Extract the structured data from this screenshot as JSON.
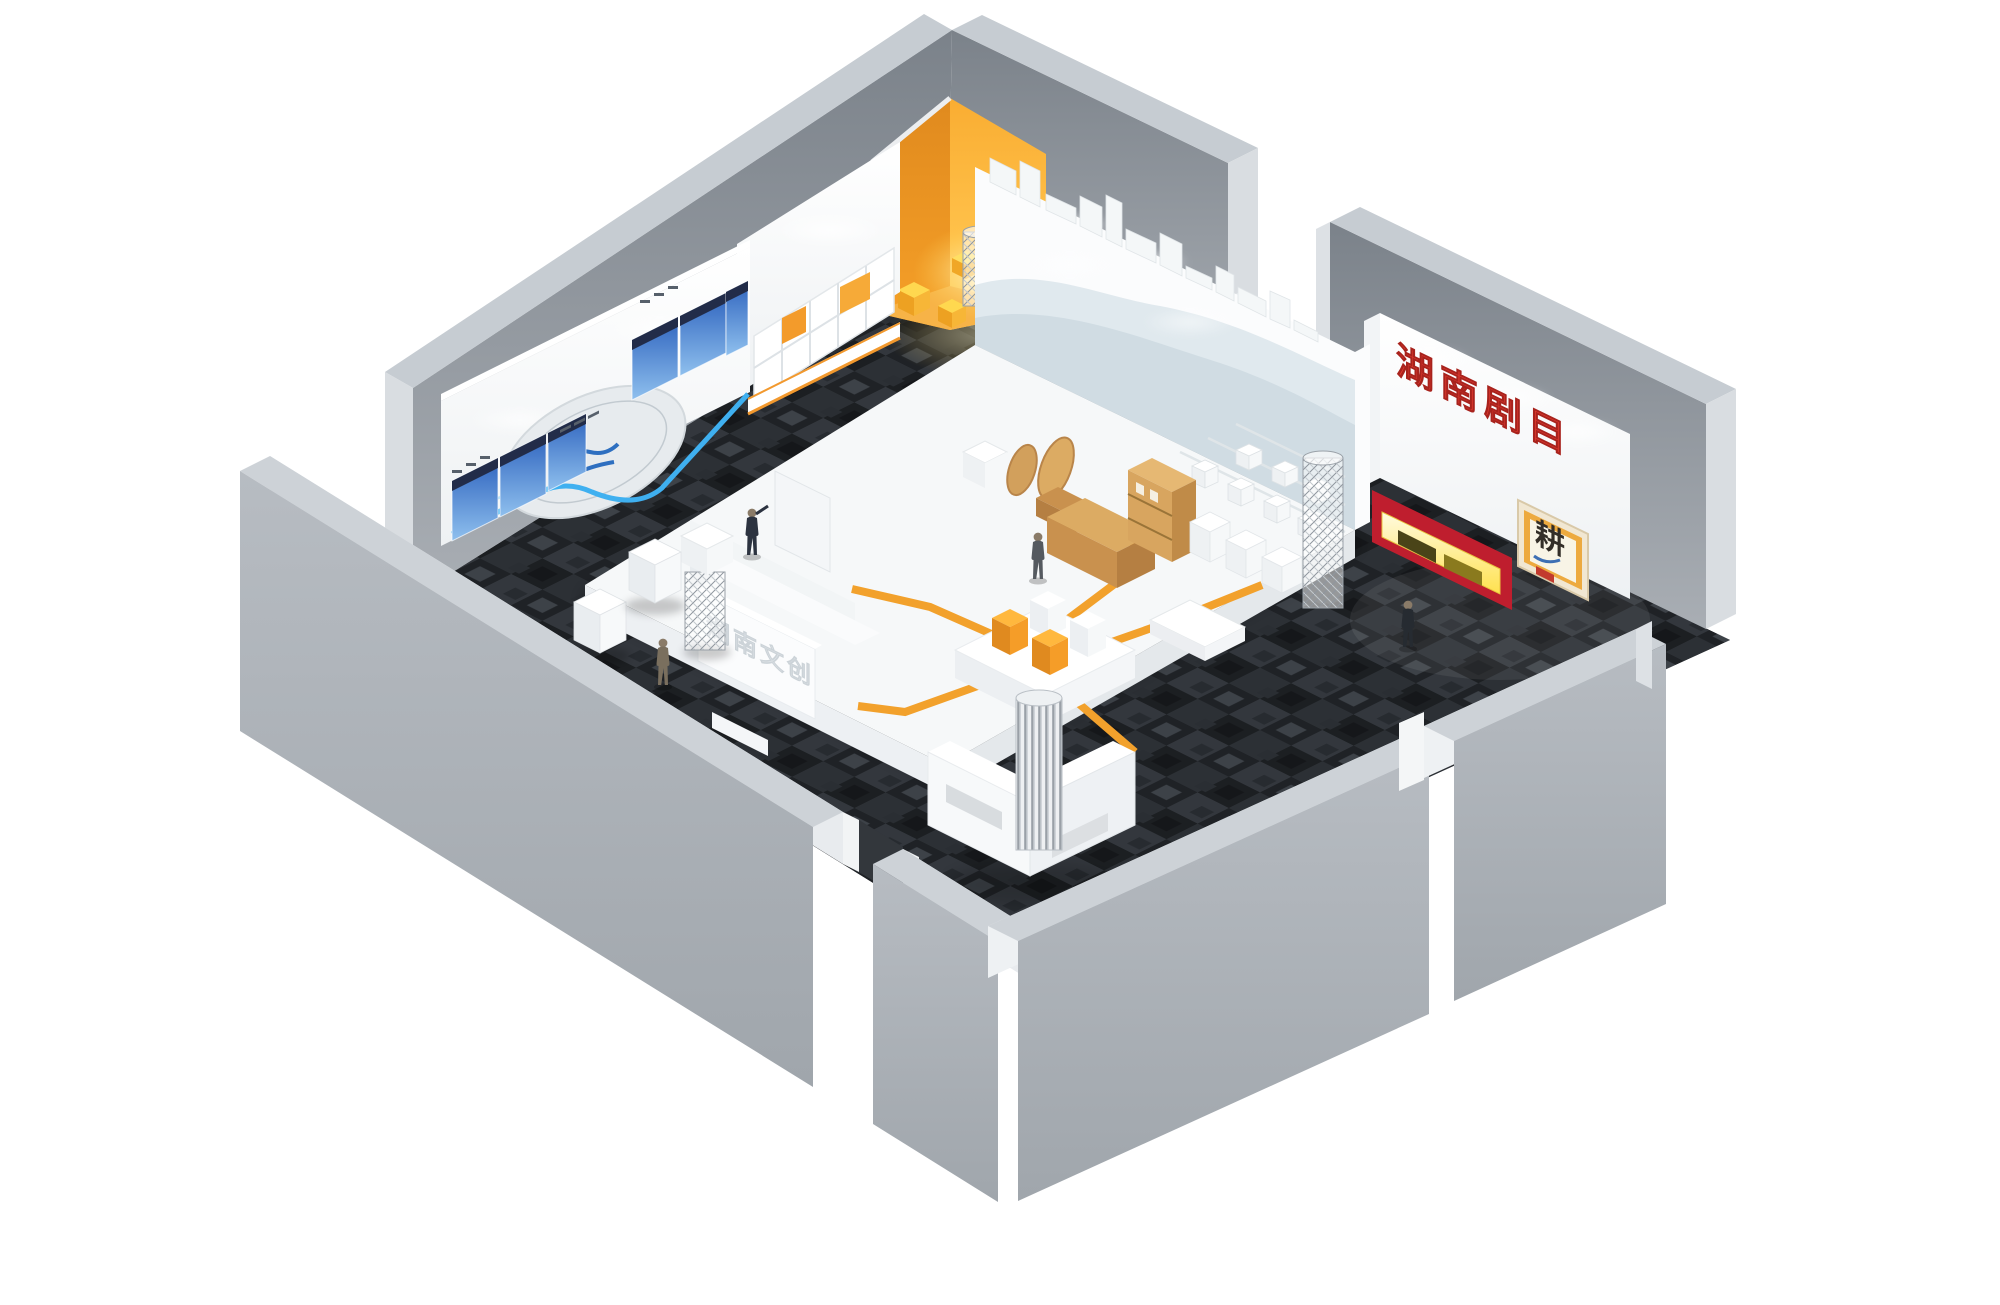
{
  "signs": {
    "creative_wall": "湖南文创",
    "drama_wall": "湖南剧目",
    "poster_character": "耕",
    "platform_relief": "湖南文创"
  },
  "palette": {
    "accent_orange": "#F2A12C",
    "gold_text": "#F6B11F",
    "red_wall": "#BF1E2E",
    "red_text": "#E23A30",
    "blue_line": "#3FB0F0",
    "carpet_base": "#24272B",
    "platform_white": "#F6F8F9",
    "wood": "#DCAB63",
    "wall_gray": "#9FA5AC",
    "lit_shelf": "#FFE458"
  }
}
